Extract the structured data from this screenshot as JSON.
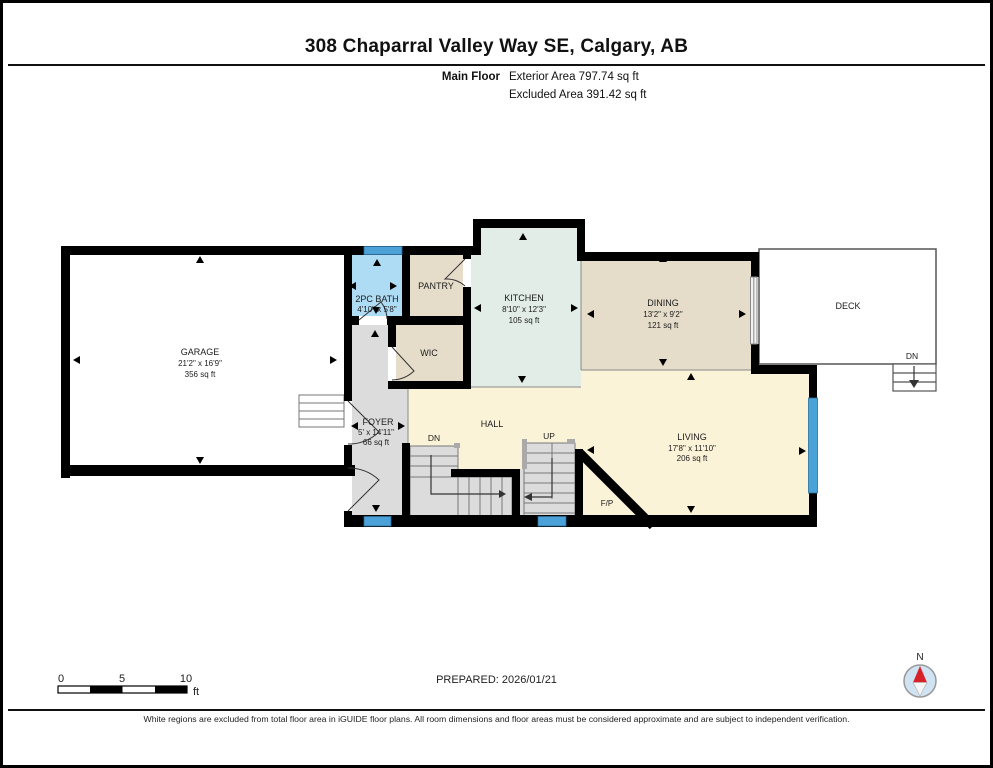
{
  "header": {
    "title": "308 Chaparral Valley Way SE, Calgary, AB",
    "floor_label": "Main Floor",
    "exterior_area": "Exterior Area 797.74 sq ft",
    "excluded_area": "Excluded Area 391.42 sq ft"
  },
  "rooms": {
    "garage": {
      "name": "GARAGE",
      "dims": "21'2\" x 16'9\"",
      "area": "356 sq ft"
    },
    "bath": {
      "name": "2PC BATH",
      "dims": "4'10\" x 5'8\""
    },
    "pantry": {
      "name": "PANTRY"
    },
    "wic": {
      "name": "WIC"
    },
    "kitchen": {
      "name": "KITCHEN",
      "dims": "8'10\" x 12'3\"",
      "area": "105 sq ft"
    },
    "dining": {
      "name": "DINING",
      "dims": "13'2\" x 9'2\"",
      "area": "121 sq ft"
    },
    "deck": {
      "name": "DECK"
    },
    "foyer": {
      "name": "FOYER",
      "dims": "5' x 14'11\"",
      "area": "66 sq ft"
    },
    "hall": {
      "name": "HALL"
    },
    "living": {
      "name": "LIVING",
      "dims": "17'8\" x 11'10\"",
      "area": "206 sq ft"
    },
    "fireplace": {
      "name": "F/P"
    }
  },
  "stairs": {
    "down_label": "DN",
    "up_label": "UP",
    "deck_down_label": "DN"
  },
  "scale_bar": {
    "tick_0": "0",
    "tick_5": "5",
    "tick_10": "10",
    "unit": "ft"
  },
  "compass": {
    "north_label": "N"
  },
  "footer": {
    "prepared": "PREPARED: 2026/01/21",
    "disclaimer": "White regions are excluded from total floor area in iGUIDE floor plans. All room dimensions and floor areas must be considered approximate and are subject to independent verification."
  },
  "colors": {
    "wall": "#000000",
    "window": "#4aa2d8",
    "bath_fill": "#aedcf4",
    "tan_fill": "#e5dcc9",
    "kitchen_fill": "#e1ede6",
    "cream_fill": "#fbf3d8",
    "gray_fill": "#dcdcdc",
    "white_fill": "#ffffff",
    "compass_needle": "#d8222a",
    "compass_face": "#cfe3f3"
  }
}
